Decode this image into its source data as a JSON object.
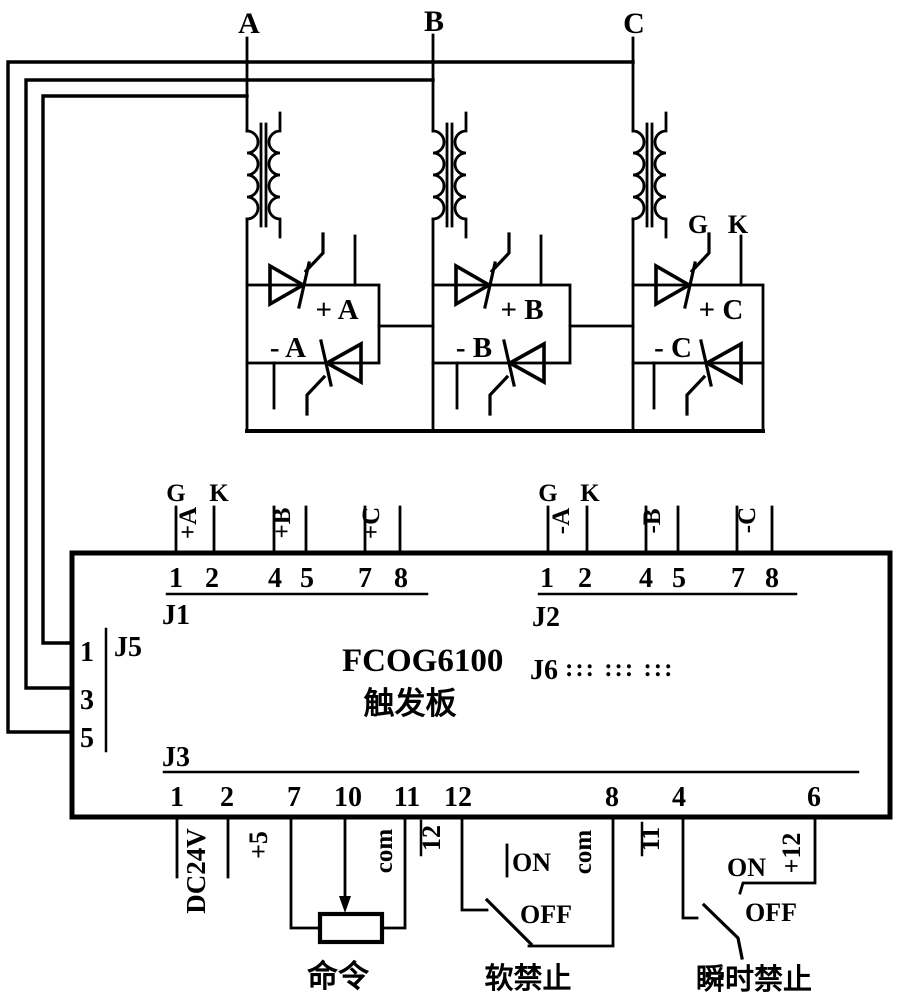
{
  "phase_labels": {
    "a": "A",
    "b": "B",
    "c": "C"
  },
  "thyristor_block": {
    "gate_label": "G",
    "cathode_label": "K",
    "modules": [
      {
        "pos": "+ A",
        "neg": "- A"
      },
      {
        "pos": "+ B",
        "neg": "- B"
      },
      {
        "pos": "+ C",
        "neg": "- C"
      }
    ]
  },
  "board": {
    "name": "FCOG6100",
    "subtitle": "触发板",
    "j1": {
      "label": "J1",
      "gate": "G",
      "cathode": "K",
      "signals": [
        "+A",
        "+B",
        "+C"
      ],
      "pins": [
        "1",
        "2",
        "4",
        "5",
        "7",
        "8"
      ]
    },
    "j2": {
      "label": "J2",
      "gate": "G",
      "cathode": "K",
      "signals": [
        "-A",
        "-B",
        "-C"
      ],
      "pins": [
        "1",
        "2",
        "4",
        "5",
        "7",
        "8"
      ]
    },
    "j5": {
      "label": "J5",
      "pins": [
        "1",
        "3",
        "5"
      ]
    },
    "j6": {
      "label": "J6",
      "dots": "::: ::: :::"
    },
    "j3": {
      "label": "J3",
      "pins": [
        "1",
        "2",
        "7",
        "10",
        "11",
        "12",
        "8",
        "4",
        "6"
      ]
    }
  },
  "io": {
    "dc24v": "DC24V",
    "plus5": "+5",
    "com_command": "com",
    "inv12": "12",
    "com_soft": "com",
    "inv11": "11",
    "plus12": "+12",
    "command_caption": "命令",
    "soft_inhibit": {
      "on": "ON",
      "off": "OFF",
      "caption": "软禁止"
    },
    "instant_inhibit": {
      "on": "ON",
      "off": "OFF",
      "caption": "瞬时禁止"
    }
  },
  "colors": {
    "ink": "#000000",
    "paper": "#ffffff"
  }
}
